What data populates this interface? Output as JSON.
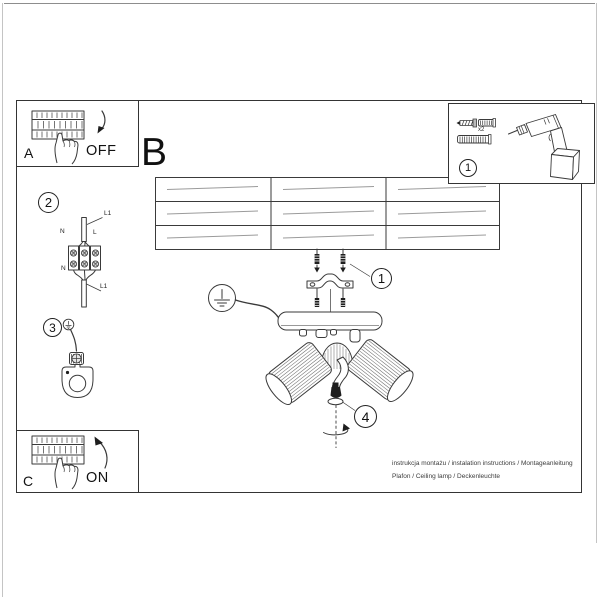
{
  "document": {
    "footer": {
      "line1": "instrukcja montażu / instalation instructions / Montageanleitung",
      "line2": "Plafon / Ceiling lamp / Deckenleuchte"
    }
  },
  "panels": {
    "breaker_off": {
      "label": "A",
      "state": "OFF"
    },
    "breaker_on": {
      "label": "C",
      "state": "ON"
    },
    "main_diagram_label": "B"
  },
  "steps": {
    "tools": "1",
    "mount": "1",
    "wiring": "2",
    "ground": "3",
    "bulb": "4"
  },
  "hardware": {
    "screw_quantity": "x2"
  },
  "wiring": {
    "l1_top": "L1",
    "n_top": "N",
    "l_top": "L",
    "n_bottom": "N",
    "l_bottom": "L",
    "l1_bottom": "L1"
  },
  "colors": {
    "ink": "#1f1f1f",
    "line": "#3a3a3a",
    "rib": "#6f6f6f",
    "plank": "#9b9b9b"
  }
}
